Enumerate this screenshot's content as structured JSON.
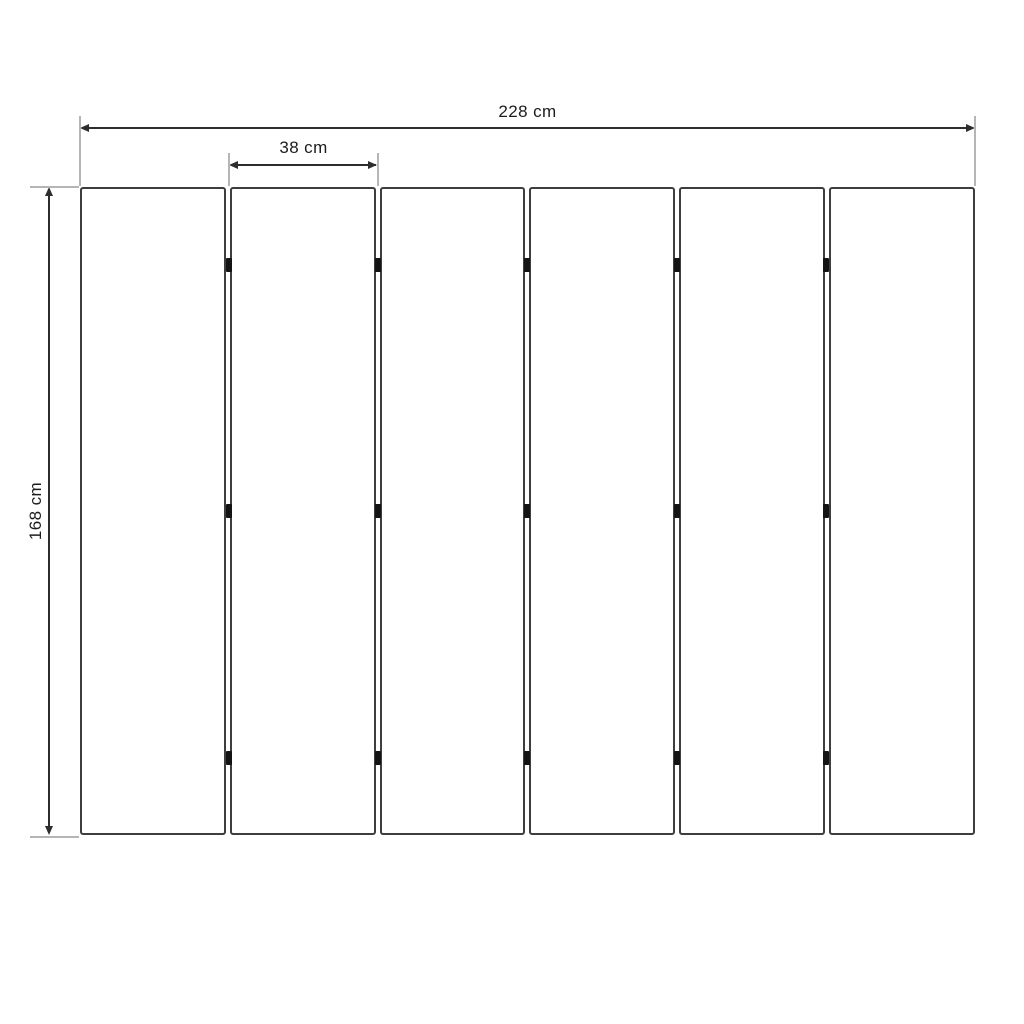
{
  "diagram": {
    "subject": "six-panel-folding-screen-front-elevation",
    "panel_count": 6,
    "gap_count": 5,
    "hinge_rows_per_gap": 3,
    "labels": {
      "total_width": "228 cm",
      "panel_width": "38 cm",
      "panel_height": "168 cm"
    },
    "colors": {
      "background": "#ffffff",
      "panel_border": "#3e3e3e",
      "dimension_line": "#2d2d2d",
      "extension_line": "#b5b5b5",
      "hinge": "#141414",
      "text": "#1c1c1c"
    }
  }
}
